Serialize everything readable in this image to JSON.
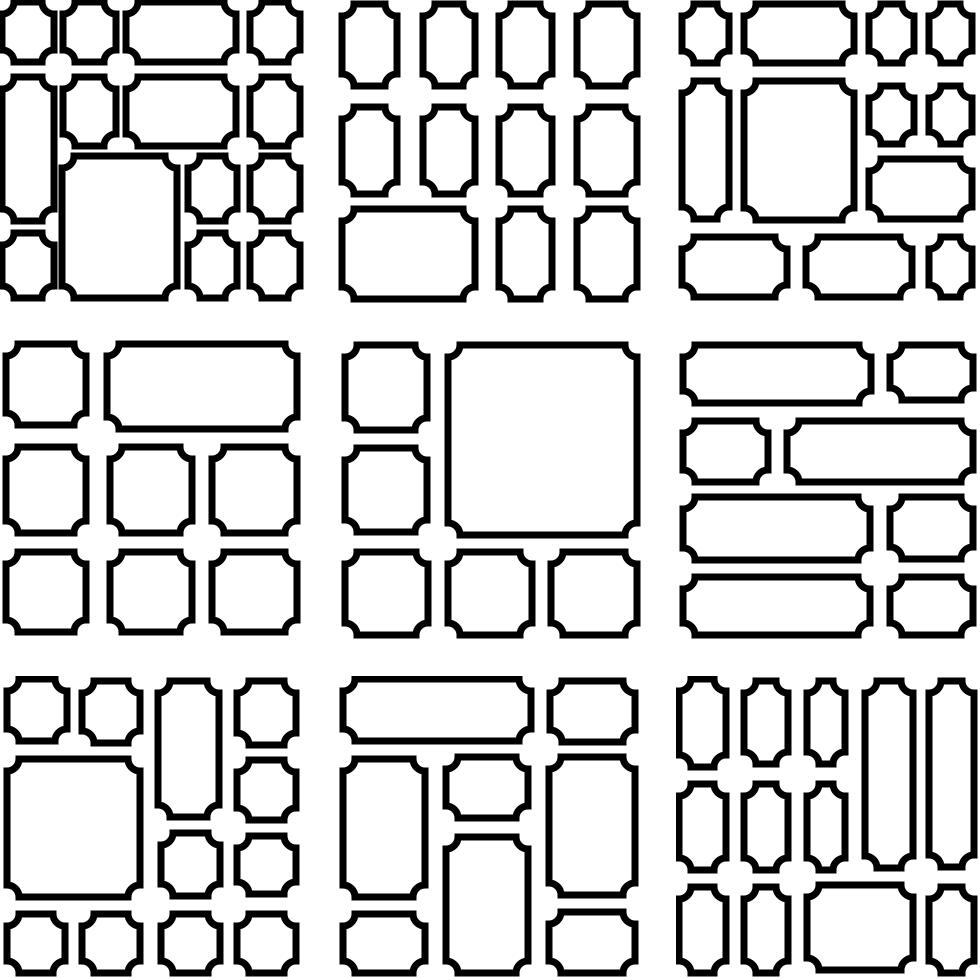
{
  "canvas": {
    "width": 980,
    "height": 980,
    "background_color": "#ffffff"
  },
  "pattern_set": {
    "description": "3x3 sheet of seamless mosaic frame patterns; white rectangles with black outlines and concave corners",
    "stroke_color": "#000000",
    "fill_color": "#ffffff",
    "stroke_width": 7,
    "corner_radius": 12,
    "tile_size": 304,
    "tile_positions": [
      0,
      338,
      676
    ],
    "tiles": [
      {
        "name": "tile-1",
        "row": 0,
        "col": 0,
        "shapes": [
          [
            2,
            2,
            52,
            60
          ],
          [
            63,
            2,
            53,
            60
          ],
          [
            126,
            2,
            110,
            60
          ],
          [
            250,
            2,
            50,
            60
          ],
          [
            2,
            77,
            52,
            144
          ],
          [
            63,
            77,
            53,
            69
          ],
          [
            126,
            77,
            110,
            69
          ],
          [
            250,
            77,
            50,
            69
          ],
          [
            62,
            156,
            115,
            142
          ],
          [
            188,
            156,
            49,
            65
          ],
          [
            250,
            156,
            50,
            65
          ],
          [
            188,
            233,
            49,
            65
          ],
          [
            250,
            233,
            50,
            65
          ],
          [
            2,
            233,
            52,
            65
          ]
        ]
      },
      {
        "name": "tile-2",
        "row": 0,
        "col": 1,
        "shapes": [
          [
            4,
            4,
            55,
            82
          ],
          [
            85,
            4,
            52,
            82
          ],
          [
            161,
            4,
            53,
            82
          ],
          [
            239,
            4,
            60,
            82
          ],
          [
            4,
            107,
            55,
            87
          ],
          [
            85,
            107,
            52,
            87
          ],
          [
            161,
            107,
            53,
            87
          ],
          [
            239,
            107,
            60,
            87
          ],
          [
            4,
            209,
            133,
            90
          ],
          [
            161,
            209,
            53,
            90
          ],
          [
            239,
            209,
            60,
            90
          ]
        ]
      },
      {
        "name": "tile-3",
        "row": 0,
        "col": 2,
        "shapes": [
          [
            6,
            4,
            47,
            59
          ],
          [
            68,
            4,
            110,
            59
          ],
          [
            193,
            4,
            45,
            59
          ],
          [
            253,
            4,
            43,
            59
          ],
          [
            6,
            81,
            47,
            138
          ],
          [
            68,
            81,
            110,
            139
          ],
          [
            193,
            86,
            45,
            58
          ],
          [
            253,
            86,
            43,
            58
          ],
          [
            193,
            159,
            103,
            60
          ],
          [
            6,
            237,
            105,
            60
          ],
          [
            130,
            237,
            106,
            60
          ],
          [
            253,
            237,
            43,
            60
          ]
        ]
      },
      {
        "name": "tile-4",
        "row": 1,
        "col": 0,
        "shapes": [
          [
            6,
            6,
            80,
            81
          ],
          [
            107,
            6,
            190,
            85
          ],
          [
            6,
            109,
            80,
            86
          ],
          [
            110,
            109,
            82,
            86
          ],
          [
            212,
            109,
            85,
            86
          ],
          [
            6,
            214,
            80,
            80
          ],
          [
            110,
            214,
            82,
            80
          ],
          [
            212,
            214,
            85,
            80
          ]
        ]
      },
      {
        "name": "tile-5",
        "row": 1,
        "col": 1,
        "shapes": [
          [
            7,
            7,
            82,
            85
          ],
          [
            7,
            110,
            82,
            84
          ],
          [
            110,
            7,
            189,
            190
          ],
          [
            7,
            214,
            83,
            83
          ],
          [
            110,
            214,
            84,
            83
          ],
          [
            213,
            214,
            86,
            83
          ]
        ]
      },
      {
        "name": "tile-6",
        "row": 1,
        "col": 2,
        "shapes": [
          [
            7,
            7,
            188,
            58
          ],
          [
            214,
            7,
            83,
            55
          ],
          [
            7,
            83,
            85,
            61
          ],
          [
            111,
            83,
            186,
            61
          ],
          [
            7,
            159,
            187,
            63
          ],
          [
            214,
            159,
            83,
            62
          ],
          [
            7,
            239,
            187,
            58
          ],
          [
            214,
            239,
            83,
            58
          ]
        ]
      },
      {
        "name": "tile-7",
        "row": 2,
        "col": 0,
        "shapes": [
          [
            7,
            3,
            60,
            62
          ],
          [
            82,
            5,
            58,
            62
          ],
          [
            158,
            5,
            61,
            136
          ],
          [
            237,
            5,
            59,
            64
          ],
          [
            7,
            83,
            133,
            138
          ],
          [
            237,
            84,
            59,
            60
          ],
          [
            161,
            157,
            59,
            63
          ],
          [
            237,
            160,
            59,
            58
          ],
          [
            7,
            238,
            58,
            59
          ],
          [
            82,
            238,
            58,
            59
          ],
          [
            161,
            238,
            59,
            59
          ],
          [
            237,
            238,
            59,
            59
          ]
        ]
      },
      {
        "name": "tile-8",
        "row": 2,
        "col": 1,
        "shapes": [
          [
            5,
            3,
            188,
            62
          ],
          [
            212,
            5,
            85,
            61
          ],
          [
            5,
            83,
            82,
            138
          ],
          [
            108,
            81,
            82,
            61
          ],
          [
            108,
            161,
            82,
            136
          ],
          [
            211,
            81,
            86,
            138
          ],
          [
            5,
            238,
            82,
            59
          ],
          [
            211,
            236,
            86,
            61
          ]
        ]
      },
      {
        "name": "tile-9",
        "row": 2,
        "col": 2,
        "shapes": [
          [
            3,
            3,
            47,
            88
          ],
          [
            68,
            5,
            44,
            83
          ],
          [
            131,
            5,
            38,
            83
          ],
          [
            189,
            5,
            48,
            187
          ],
          [
            253,
            5,
            45,
            186
          ],
          [
            3,
            108,
            47,
            86
          ],
          [
            68,
            108,
            44,
            86
          ],
          [
            131,
            108,
            38,
            86
          ],
          [
            3,
            211,
            47,
            86
          ],
          [
            68,
            211,
            44,
            86
          ],
          [
            131,
            209,
            106,
            85
          ],
          [
            253,
            211,
            45,
            86
          ]
        ]
      }
    ]
  }
}
